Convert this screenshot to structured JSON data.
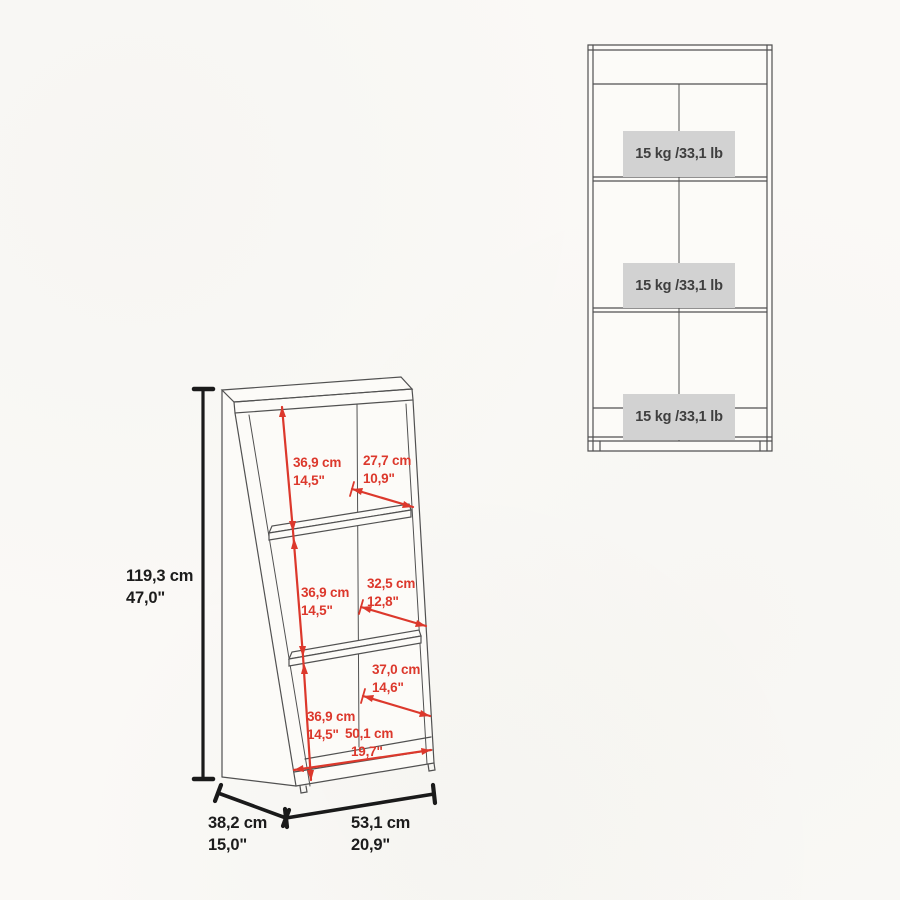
{
  "colors": {
    "background": "#faf9f6",
    "dimension_red": "#dc382c",
    "furniture_line": "#515151",
    "dimension_black": "#1c1c1c",
    "badge_background": "#d2d2d2",
    "badge_text": "#3f3f3f"
  },
  "perspective_view": {
    "overall_height": {
      "cm": "119,3 cm",
      "inch": "47,0\""
    },
    "overall_depth": {
      "cm": "38,2 cm",
      "inch": "15,0\""
    },
    "overall_width": {
      "cm": "53,1 cm",
      "inch": "20,9\""
    },
    "inner_width": {
      "cm": "50,1 cm",
      "inch": "19,7\""
    },
    "compartments": [
      {
        "height": {
          "cm": "36,9 cm",
          "inch": "14,5\""
        },
        "depth": {
          "cm": "27,7 cm",
          "inch": "10,9\""
        }
      },
      {
        "height": {
          "cm": "36,9 cm",
          "inch": "14,5\""
        },
        "depth": {
          "cm": "32,5 cm",
          "inch": "12,8\""
        }
      },
      {
        "height": {
          "cm": "36,9 cm",
          "inch": "14,5\""
        },
        "depth": {
          "cm": "37,0 cm",
          "inch": "14,6\""
        }
      }
    ]
  },
  "front_view": {
    "shelves": [
      {
        "capacity": "15 kg /33,1 lb"
      },
      {
        "capacity": "15 kg /33,1 lb"
      },
      {
        "capacity": "15 kg /33,1 lb"
      }
    ]
  }
}
